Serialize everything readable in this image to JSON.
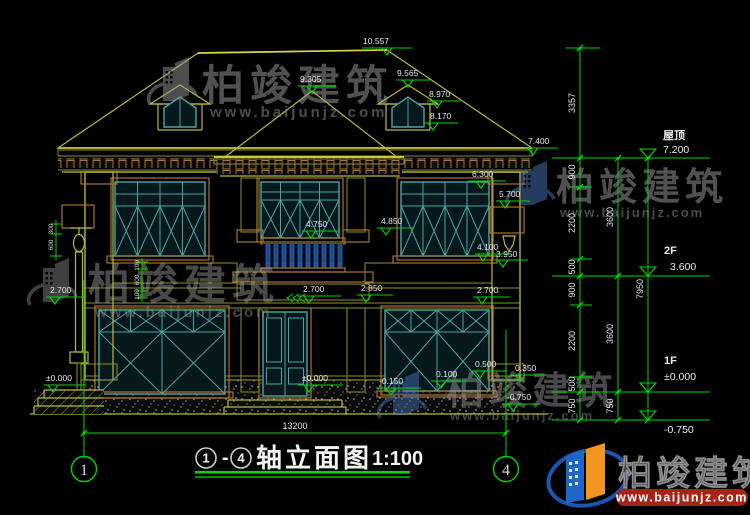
{
  "drawing": {
    "type": "house elevation, CAD",
    "scale_note": "1:100"
  },
  "title": {
    "axis_from": "1",
    "dash": "-",
    "axis_to": "4",
    "name": "轴立面图",
    "scale": "1:100"
  },
  "axis_bubbles": {
    "left": "1",
    "right": "4"
  },
  "dims": {
    "overall_width": "13200"
  },
  "levels": {
    "roof": {
      "label": "屋顶",
      "value": "7.200"
    },
    "f2": {
      "label": "2F",
      "value": "3.600"
    },
    "f1": {
      "label": "1F",
      "value": "±0.000"
    },
    "ground": {
      "value": "-0.750"
    }
  },
  "markers": [
    "10.557",
    "9.565",
    "8.970",
    "8.170",
    "9.305",
    "7.400",
    "6.300",
    "5.700",
    "4.750",
    "4.850",
    "4.100",
    "3.950",
    "2.850",
    "2.700",
    "2.700",
    "2.700",
    "0.500",
    "0.350",
    "0.100",
    "±0.000",
    "±0.000",
    "-0.150",
    "-0.750"
  ],
  "right_dims": {
    "chain1": [
      "3357",
      "900",
      "2200",
      "500",
      "900",
      "2200",
      "500",
      "750"
    ],
    "chain2": [
      "3600",
      "3600",
      "750"
    ],
    "chain3": [
      "7950"
    ]
  },
  "small_dims": {
    "balcony": [
      "100",
      "600",
      "100"
    ],
    "post": [
      "300",
      "600"
    ]
  },
  "watermark": {
    "brand": "柏竣建筑",
    "url": "www.baijunjz.com"
  },
  "colors": {
    "background": "#000000",
    "cad_yellow": "#b9b93c",
    "cad_green": "#00d800",
    "window_teal": "#4aa5a5",
    "trim_brown": "#a8742f",
    "logo_blue": "#1e66c8",
    "logo_orange": "#f2971e",
    "url_box_red": "#a62317"
  }
}
